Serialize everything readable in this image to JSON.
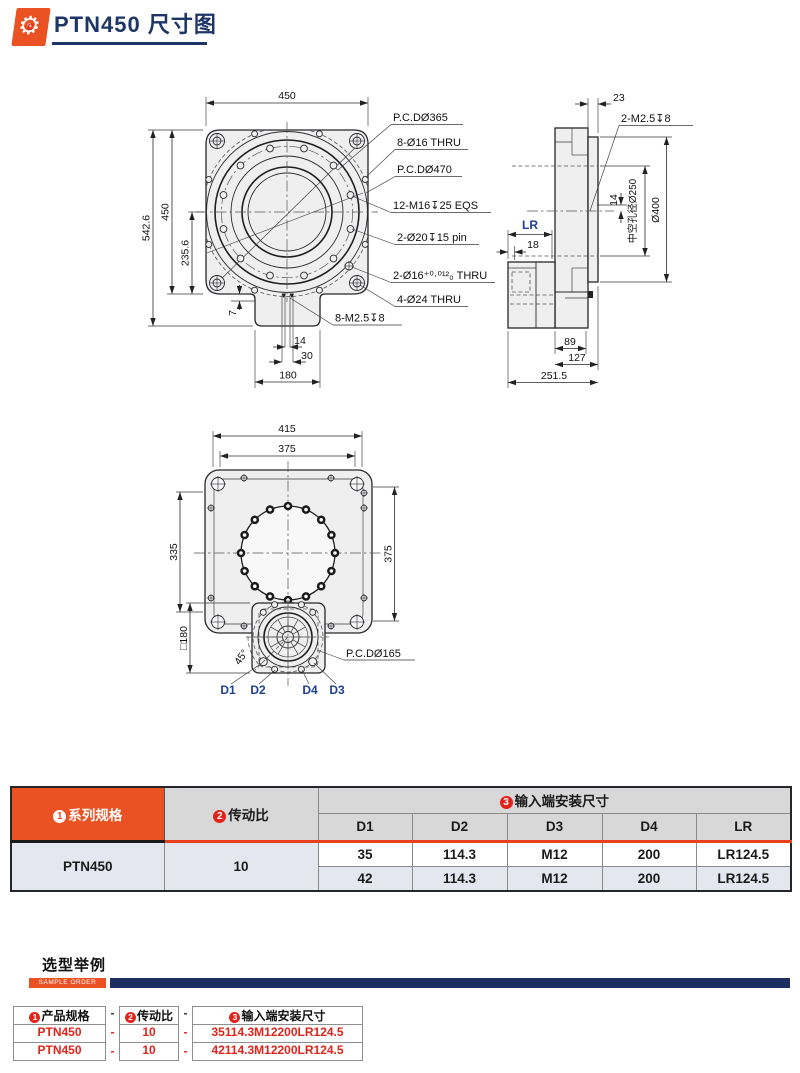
{
  "colors": {
    "orange": "#ea5123",
    "navy_title": "#1d3666",
    "navy_bar": "#1d2e61",
    "red": "#e2231a",
    "table_gray": "#d8d8d8",
    "row_light": "#e4e7ef",
    "rule_red": "#e8401c",
    "blue_label": "#1e3f96"
  },
  "header": {
    "title": "PTN450 尺寸图"
  },
  "front_view": {
    "dims": {
      "w": "450",
      "h_total": "542.6",
      "h": "450",
      "c": "235.6",
      "t7": "7",
      "s14": "14",
      "s30": "30",
      "tab": "180"
    },
    "labels": {
      "pcd365": "P.C.DØ365",
      "o16": "8-Ø16 THRU",
      "pcd470": "P.C.DØ470",
      "m16": "12-M16↧25 EQS",
      "o20": "2-Ø20↧15 pin",
      "o16t": "2-Ø16⁺⁰·⁰¹²₀ THRU",
      "o24": "4-Ø24 THRU",
      "m25": "8-M2.5↧8"
    }
  },
  "side_view": {
    "dims": {
      "d23": "23",
      "d14": "14",
      "d18": "18",
      "d89": "89",
      "d127": "127",
      "d2515": "251.5"
    },
    "labels": {
      "m25": "2-M2.5↧8",
      "bore": "中空孔径Ø250",
      "o400": "Ø400",
      "lr": "LR"
    }
  },
  "bottom_view": {
    "dims": {
      "d415": "415",
      "d375t": "375",
      "d335": "335",
      "d375r": "375",
      "d180": "□180",
      "a45": "45°"
    },
    "labels": {
      "pcd165": "P.C.DØ165",
      "d1": "D1",
      "d2": "D2",
      "d4": "D4",
      "d3": "D3"
    }
  },
  "spec_table": {
    "headers": {
      "series_no": "1",
      "series": "系列规格",
      "ratio_no": "2",
      "ratio": "传动比",
      "input_no": "3",
      "input": "输入端安装尺寸"
    },
    "subheaders": [
      "D1",
      "D2",
      "D3",
      "D4",
      "LR"
    ],
    "series_value": "PTN450",
    "ratio_value": "10",
    "rows": [
      [
        "35",
        "114.3",
        "M12",
        "200",
        "LR124.5"
      ],
      [
        "42",
        "114.3",
        "M12",
        "200",
        "LR124.5"
      ]
    ]
  },
  "sample_order": {
    "title": "选型举例",
    "tag": "SAMPLE ORDER",
    "headers": {
      "h1_no": "1",
      "h1": "产品规格",
      "h2_no": "2",
      "h2": "传动比",
      "h3_no": "3",
      "h3": "输入端安装尺寸"
    },
    "dash": "-",
    "rows": [
      [
        "PTN450",
        "10",
        "35114.3M12200LR124.5"
      ],
      [
        "PTN450",
        "10",
        "42114.3M12200LR124.5"
      ]
    ]
  }
}
